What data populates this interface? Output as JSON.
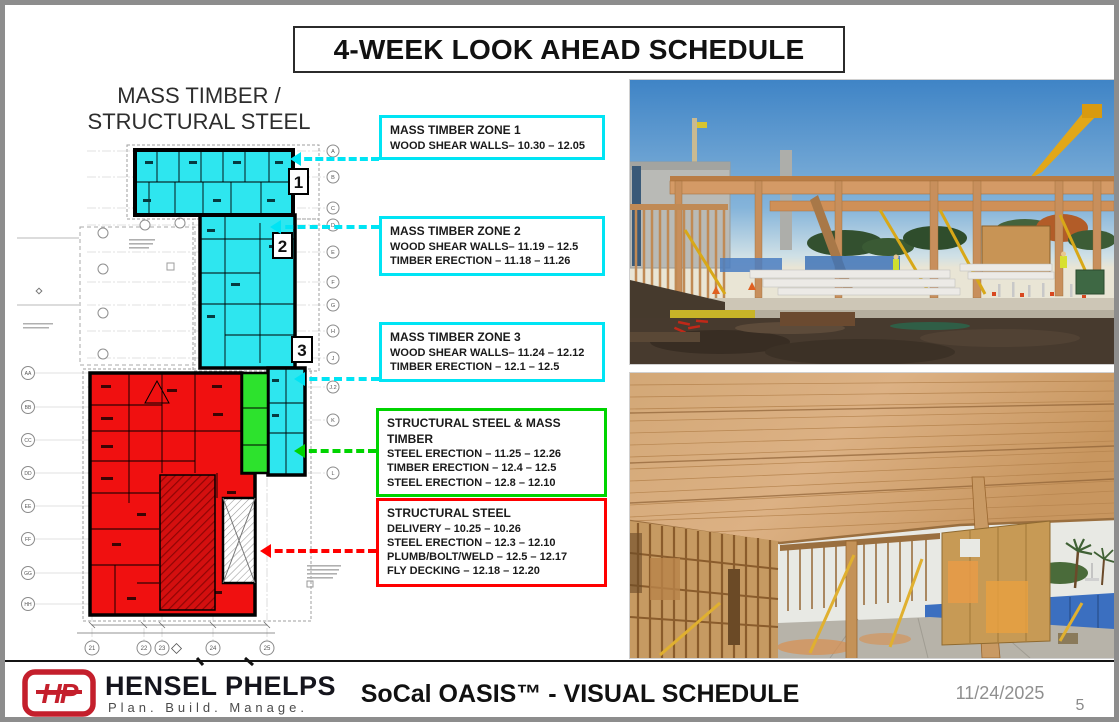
{
  "slide_title": "4-WEEK LOOK AHEAD SCHEDULE",
  "plan": {
    "heading_line1": "MASS TIMBER /",
    "heading_line2": "STRUCTURAL STEEL",
    "zone_labels": [
      "1",
      "2",
      "3"
    ],
    "grid_labels_right": [
      "A",
      "B",
      "C",
      "D",
      "E",
      "F",
      "G",
      "H",
      "J",
      "J.2",
      "K",
      "L"
    ],
    "grid_labels_left": [
      "AA",
      "BB",
      "CC",
      "DD",
      "EE",
      "FF",
      "GG",
      "HH"
    ],
    "grid_labels_bottom": [
      "21",
      "22",
      "23",
      "24",
      "25"
    ],
    "zone_colors": {
      "mass_timber_fill": "#2ee6ef",
      "structural_steel_fill": "#f01010",
      "steel_and_timber_fill": "#2de22d"
    }
  },
  "callouts": [
    {
      "title": "MASS TIMBER ZONE 1",
      "lines": [
        "WOOD SHEAR WALLS– 10.30 – 12.05"
      ],
      "accent": "#00e4f4"
    },
    {
      "title": "MASS TIMBER ZONE 2",
      "lines": [
        "WOOD SHEAR WALLS– 11.19 – 12.5",
        "TIMBER ERECTION – 11.18 – 11.26"
      ],
      "accent": "#00e4f4"
    },
    {
      "title": "MASS TIMBER ZONE 3",
      "lines": [
        "WOOD SHEAR WALLS– 11.24 – 12.12",
        "TIMBER ERECTION – 12.1 – 12.5"
      ],
      "accent": "#00e4f4"
    },
    {
      "title": "STRUCTURAL STEEL & MASS TIMBER",
      "lines": [
        "STEEL ERECTION – 11.25 – 12.26",
        "TIMBER ERECTION – 12.4 – 12.5",
        "STEEL ERECTION – 12.8 – 12.10"
      ],
      "accent": "#00d400"
    },
    {
      "title": "STRUCTURAL STEEL",
      "lines": [
        "DELIVERY – 10.25 – 10.26",
        "STEEL ERECTION – 12.3 – 12.10",
        "PLUMB/BOLT/WELD – 12.5 – 12.17",
        "FLY DECKING – 12.18 – 12.20"
      ],
      "accent": "#ff0000"
    }
  ],
  "footer": {
    "logo_monogram": "HP",
    "company_name": "HENSEL PHELPS",
    "tagline": "Plan. Build. Manage.",
    "slide_footer_title": "SoCal OASIS™ - VISUAL SCHEDULE",
    "date": "11/24/2025",
    "page_number": "5"
  }
}
